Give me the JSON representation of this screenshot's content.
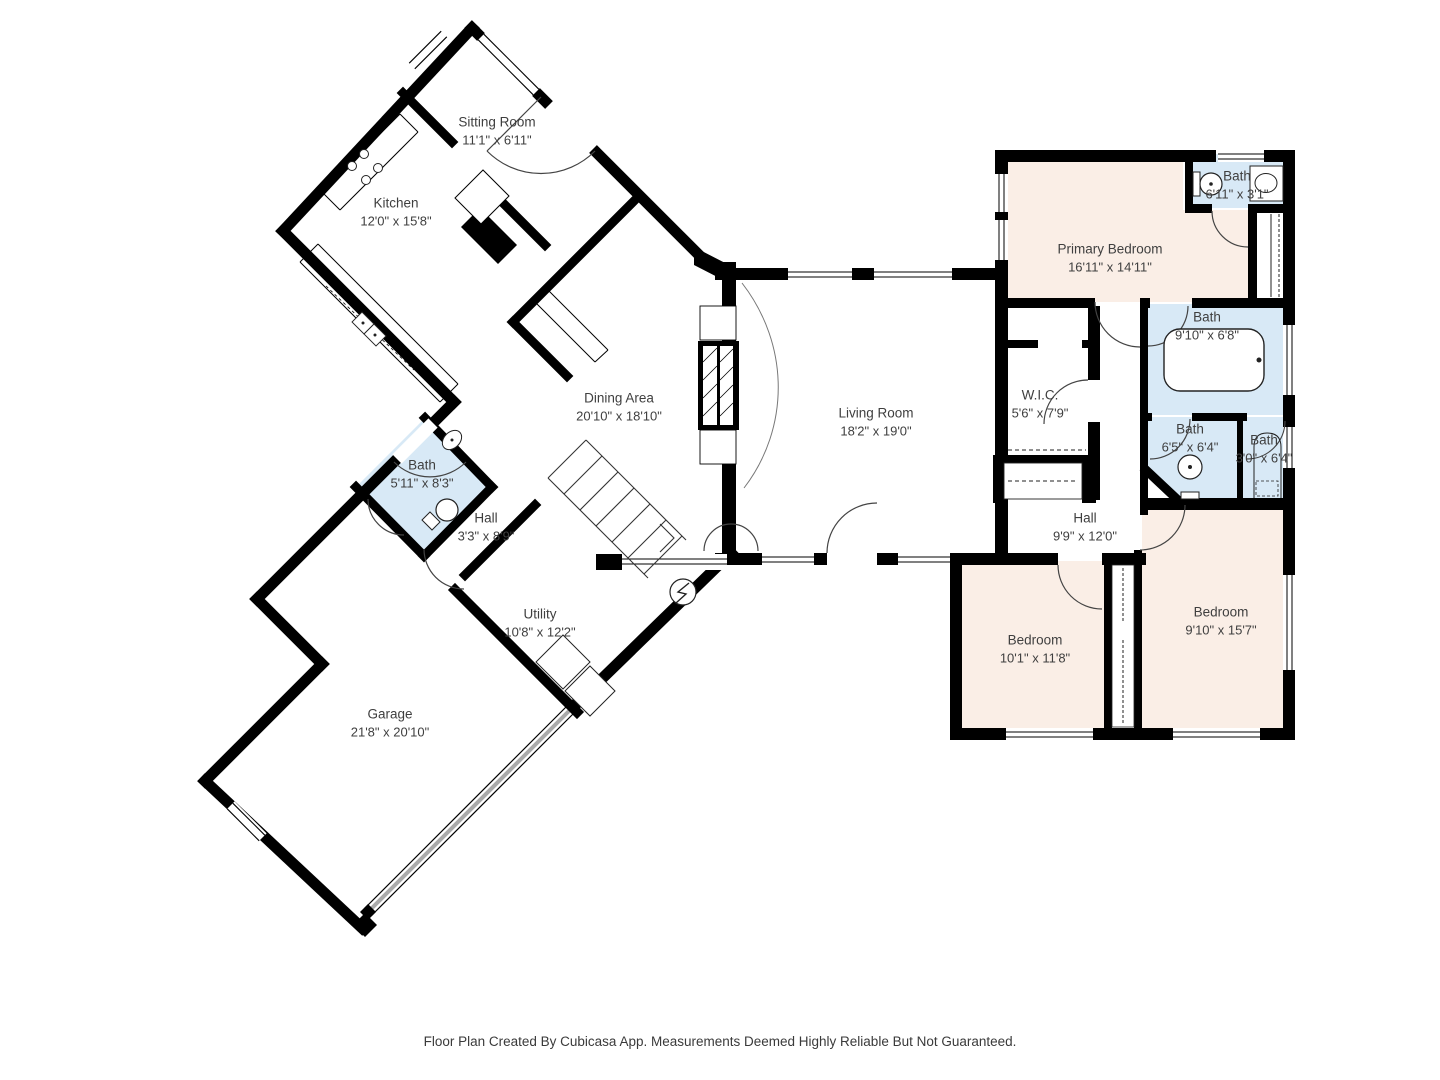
{
  "footer": {
    "text": "Floor Plan Created By Cubicasa App. Measurements Deemed Highly Reliable But Not Guaranteed."
  },
  "colors": {
    "wall": "#000000",
    "bathroom_fill": "#d8e9f6",
    "bedroom_fill": "#faeee6",
    "floor_fill": "#ffffff",
    "garage_door": "#aaaaaa",
    "label_text": "#3f3f3f"
  },
  "rooms": [
    {
      "id": "sitting-room",
      "name": "Sitting Room",
      "dims": "11'1\" x 6'11\""
    },
    {
      "id": "kitchen",
      "name": "Kitchen",
      "dims": "12'0\" x 15'8\""
    },
    {
      "id": "dining-area",
      "name": "Dining Area",
      "dims": "20'10\" x 18'10\""
    },
    {
      "id": "living-room",
      "name": "Living Room",
      "dims": "18'2\" x 19'0\""
    },
    {
      "id": "primary-bedroom",
      "name": "Primary Bedroom",
      "dims": "16'11\" x 14'11\""
    },
    {
      "id": "bath-top-right",
      "name": "Bath",
      "dims": "6'11\" x 3'1\""
    },
    {
      "id": "bath-large",
      "name": "Bath",
      "dims": "9'10\" x 6'8\""
    },
    {
      "id": "bath-65",
      "name": "Bath",
      "dims": "6'5\" x 6'4\""
    },
    {
      "id": "bath-30",
      "name": "Bath",
      "dims": "3'0\" x 6'4\""
    },
    {
      "id": "wic",
      "name": "W.I.C.",
      "dims": "5'6\" x 7'9\""
    },
    {
      "id": "hall-right",
      "name": "Hall",
      "dims": "9'9\" x 12'0\""
    },
    {
      "id": "bedroom-left",
      "name": "Bedroom",
      "dims": "10'1\" x 11'8\""
    },
    {
      "id": "bedroom-right",
      "name": "Bedroom",
      "dims": "9'10\" x 15'7\""
    },
    {
      "id": "bath-left",
      "name": "Bath",
      "dims": "5'11\" x 8'3\""
    },
    {
      "id": "hall-left",
      "name": "Hall",
      "dims": "3'3\" x 8'9\""
    },
    {
      "id": "utility",
      "name": "Utility",
      "dims": "10'8\" x 12'2\""
    },
    {
      "id": "garage",
      "name": "Garage",
      "dims": "21'8\" x 20'10\""
    }
  ]
}
